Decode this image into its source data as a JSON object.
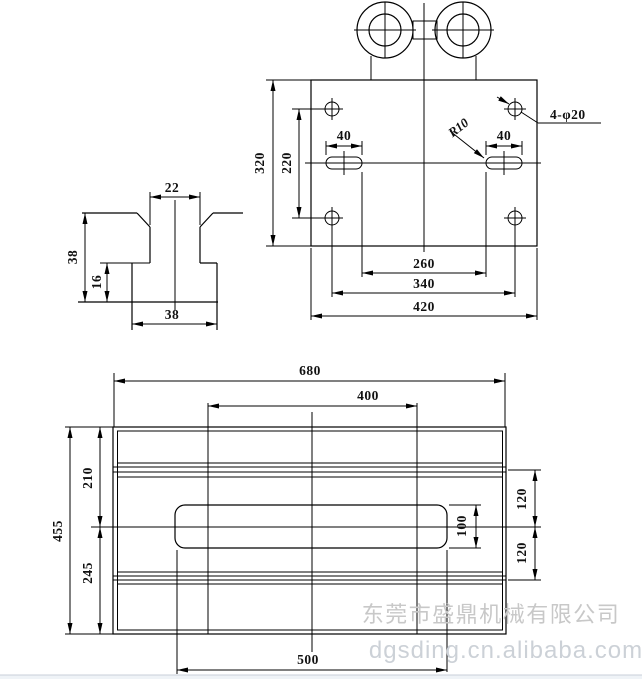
{
  "top_view": {
    "d320": "320",
    "d220": "220",
    "d40_left": "40",
    "d40_right": "40",
    "r10": "R10",
    "holes_label": "4-φ20",
    "d260": "260",
    "d340": "340",
    "d420": "420"
  },
  "profile_view": {
    "d22": "22",
    "d38_height": "38",
    "d16": "16",
    "d38_width": "38"
  },
  "bottom_view": {
    "d680": "680",
    "d400": "400",
    "d455": "455",
    "d210": "210",
    "d245": "245",
    "d120_top": "120",
    "d120_bottom": "120",
    "d100": "100",
    "d500": "500"
  },
  "watermark": {
    "company": "东莞市盛鼎机械有限公司",
    "website": "dgsding.cn.alibaba.com"
  }
}
